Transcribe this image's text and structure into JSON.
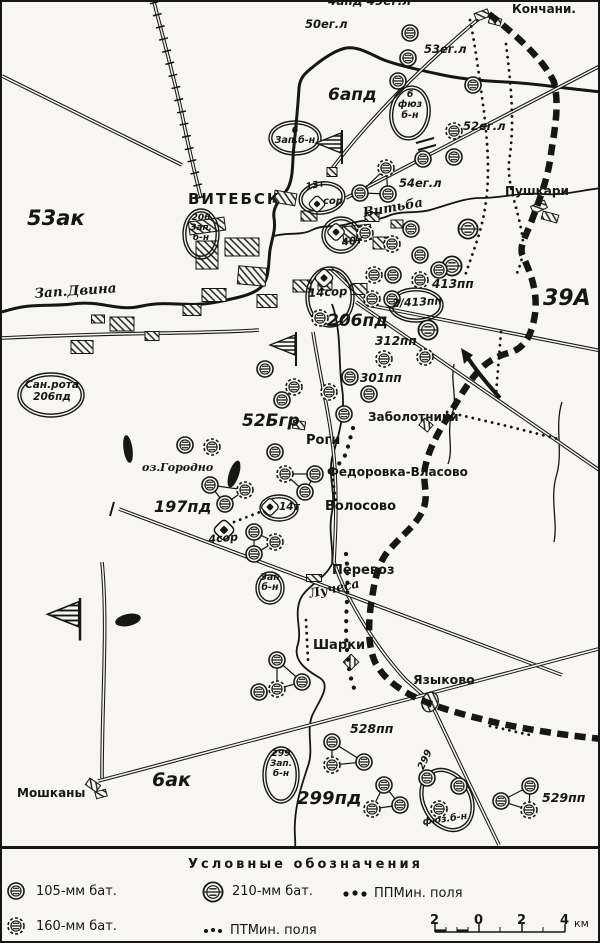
{
  "labels": {
    "frag_top": "4апд 49ег.л",
    "egl50": "50ег.л",
    "egl53": "53ег.л",
    "egl52": "52ег.л",
    "egl54": "54ег.л",
    "apd6": "6апд",
    "konchani": "Кончани.",
    "pushkari": "Пушкари",
    "vitebsk": "ВИТЕБСК",
    "ak53": "53ак",
    "a39": "39А",
    "dvina": "Зап.Двина",
    "vitba": "Витьба",
    "luchesa": "Лучеса",
    "gorodno": "оз.Городно",
    "pd206": "206пд",
    "pp413": "413пп",
    "pp413_2": "2/413пп",
    "pp312": "312пп",
    "pp301": "301пп",
    "br52": "52Бгр",
    "zabolotniki": "Заболотники",
    "rogi": "Роги",
    "fedorovka": "Федоровка-Власово",
    "volosovo": "Волосово",
    "pd197": "197пд",
    "perevoz": "Перевоз",
    "sharki": "Шарки",
    "yazykovo": "Языково",
    "moshkany": "Мошканы",
    "ak6": "6ак",
    "pd299": "299пд",
    "pp528": "528пп",
    "pp529": "529пп",
    "oval_zap206": "206\nЗап.\nб-н",
    "oval_zap6": "6\nЗап.б-н",
    "oval_fuz6": "6\nфюз\nб-н",
    "oval_sanrota": "Сан.рота\n206пд",
    "t13": "13т",
    "sor13": "сор",
    "t40": "40т",
    "sor14": "14сор",
    "t14": "14т",
    "sor4": "4сор",
    "oval_zapbn": "Зап\nб-н",
    "oval_zap299": "299\nЗап.\nб-н",
    "fuz299_num": "299",
    "fuz299": "фюз.б-н"
  },
  "legend": {
    "title": "Условные обозначения",
    "items": [
      {
        "label": "105-мм бат."
      },
      {
        "label": "210-мм бат."
      },
      {
        "label": "ППМин. поля"
      },
      {
        "label": "160-мм бат."
      },
      {
        "label": "ПТМин. поля"
      }
    ],
    "scale": {
      "t0": "2",
      "t1": "0",
      "t2": "2",
      "t3": "4",
      "unit": "км"
    }
  }
}
